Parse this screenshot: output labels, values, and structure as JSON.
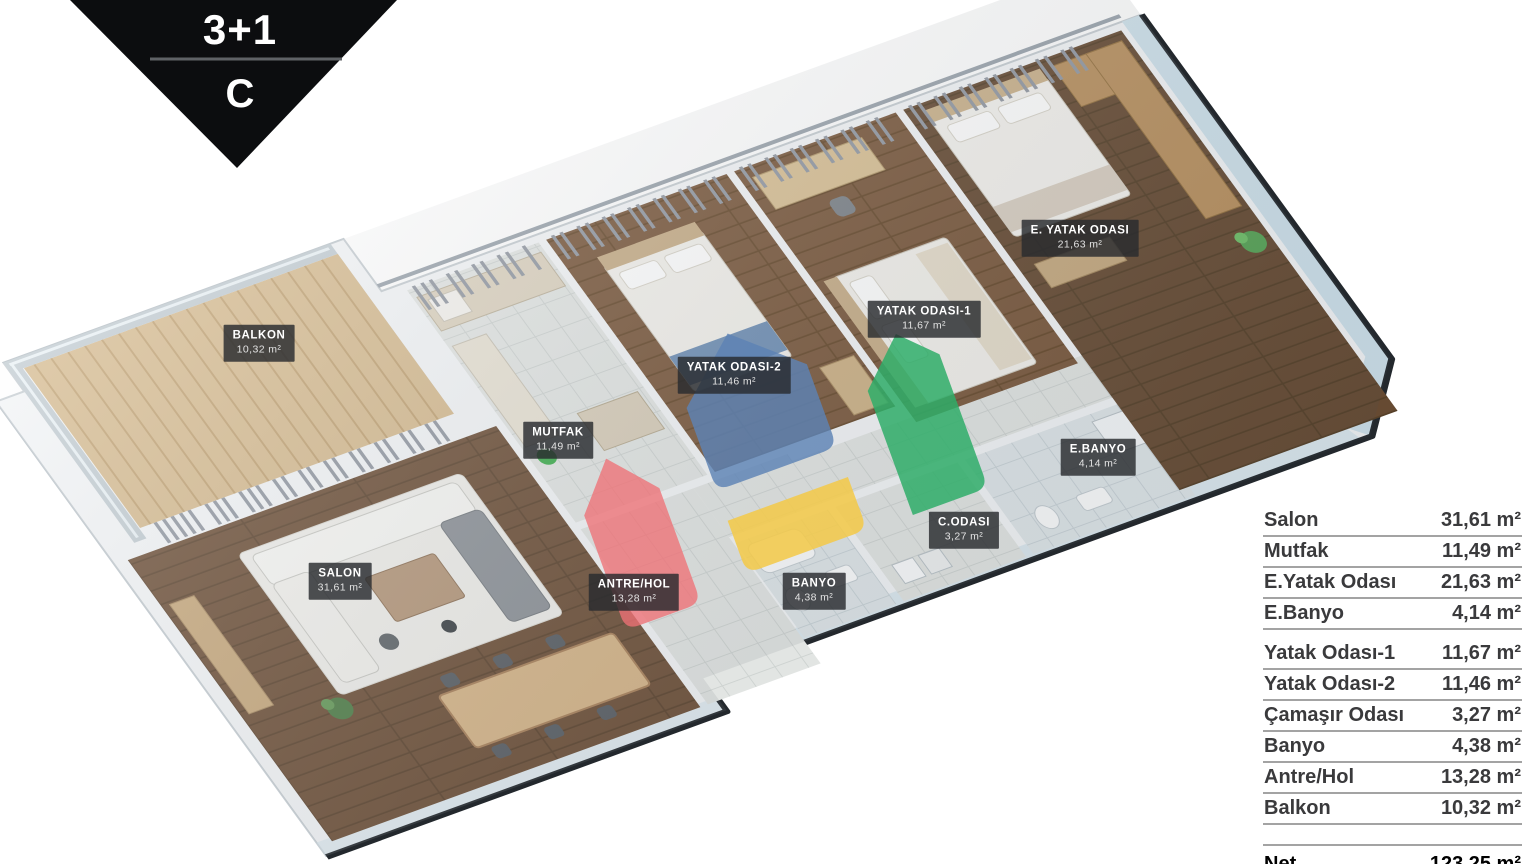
{
  "badge": {
    "type_label": "3+1",
    "block_label": "C"
  },
  "plan_labels": [
    {
      "id": "balkon",
      "name": "BALKON",
      "area": "10,32 m²"
    },
    {
      "id": "salon",
      "name": "SALON",
      "area": "31,61 m²"
    },
    {
      "id": "mutfak",
      "name": "MUTFAK",
      "area": "11,49 m²"
    },
    {
      "id": "antre",
      "name": "ANTRE/HOL",
      "area": "13,28 m²"
    },
    {
      "id": "yatak2",
      "name": "YATAK ODASI-2",
      "area": "11,46 m²"
    },
    {
      "id": "banyo",
      "name": "BANYO",
      "area": "4,38 m²"
    },
    {
      "id": "codasi",
      "name": "C.ODASI",
      "area": "3,27 m²"
    },
    {
      "id": "yatak1",
      "name": "YATAK ODASI-1",
      "area": "11,67 m²"
    },
    {
      "id": "eyatak",
      "name": "E. YATAK ODASI",
      "area": "21,63 m²"
    },
    {
      "id": "ebanyo",
      "name": "E.BANYO",
      "area": "4,14 m²"
    }
  ],
  "area_table": {
    "rows": [
      {
        "label": "Salon",
        "value": "31,61 m²"
      },
      {
        "label": "Mutfak",
        "value": "11,49 m²"
      },
      {
        "label": "E.Yatak Odası",
        "value": "21,63 m²"
      },
      {
        "label": "E.Banyo",
        "value": "4,14 m²"
      },
      {
        "label": "Yatak Odası-1",
        "value": "11,67 m²"
      },
      {
        "label": "Yatak Odası-2",
        "value": "11,46 m²"
      },
      {
        "label": "Çamaşır Odası",
        "value": "3,27 m²"
      },
      {
        "label": "Banyo",
        "value": "4,38 m²"
      },
      {
        "label": "Antre/Hol",
        "value": "13,28 m²"
      },
      {
        "label": "Balkon",
        "value": "10,32 m²"
      }
    ],
    "net": {
      "label": "Net",
      "value": "123,25 m²"
    }
  },
  "watermark_colors": {
    "red": "#ee7176",
    "blue": "#5d83b4",
    "green": "#2fad68",
    "yellow": "#f2ca4b"
  },
  "palette": {
    "wood_dark": "#6d4f37",
    "tile": "#e2e5e3",
    "wall": "#f3f5f7",
    "edge_dark": "#23282d",
    "outer_blue": "#cfe2ec"
  }
}
